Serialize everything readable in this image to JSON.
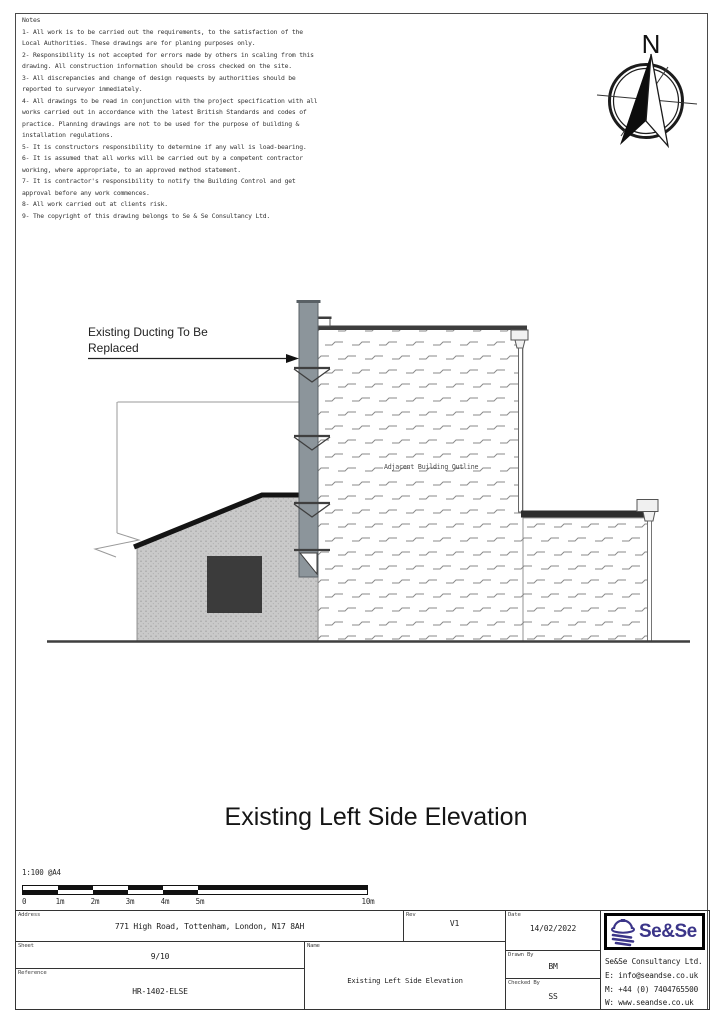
{
  "notes": {
    "title": "Notes",
    "items": [
      "1- All work is to be carried out the requirements, to the satisfaction of the Local Authorities. These drawings are for planing purposes only.",
      "2- Responsibility is not accepted for errors made by others in scaling from this drawing. All construction information should be cross checked on the site.",
      "3- All discrepancies and change of design requests by authorities should be reported to surveyor immediately.",
      "4- All drawings to be read in conjunction with the project specification with all works carried out in accordance with the latest British Standards and codes of practice. Planning drawings are not to be used for the purpose of building & installation regulations.",
      "5- It is constructors responsibility to determine if any wall is load-bearing.",
      "6- It is assumed that all works will be carried out by a competent contractor working, where appropriate, to an approved method statement.",
      "7- It is contractor's responsibility to notify the Building Control and get approval before any work commences.",
      "8- All work carried out at clients risk.",
      "9- The copyright of this drawing belongs to Se & Se Consultancy Ltd."
    ]
  },
  "compass": {
    "north_label": "N"
  },
  "drawing": {
    "duct_label_line1": "Existing Ducting To Be",
    "duct_label_line2": "Replaced",
    "adjacent_label": "Adjacent Building Outline"
  },
  "title": "Existing Left Side Elevation",
  "scale_bar": {
    "ratio": "1:100 @A4",
    "ticks": [
      "0",
      "1m",
      "2m",
      "3m",
      "4m",
      "5m",
      "10m"
    ]
  },
  "title_block": {
    "address": {
      "label": "Address",
      "value": "771 High Road, Tottenham, London, N17 8AH"
    },
    "rev": {
      "label": "Rev",
      "value": "V1"
    },
    "sheet": {
      "label": "Sheet",
      "value": "9/10"
    },
    "reference": {
      "label": "Reference",
      "value": "HR-1402-ELSE"
    },
    "name": {
      "label": "Name",
      "value": "Existing Left Side Elevation"
    },
    "date": {
      "label": "Date",
      "value": "14/02/2022"
    },
    "drawn_by": {
      "label": "Drawn By",
      "value": "BM"
    },
    "checked_by": {
      "label": "Checked By",
      "value": "SS"
    },
    "company": {
      "logo_text": "Se&Se",
      "name": "Se&Se Consultancy Ltd.",
      "email": "E: info@seandse.co.uk",
      "mobile": "M: +44 (0) 7404765500",
      "web": "W: www.seandse.co.uk",
      "brand_color": "#3b3589"
    }
  }
}
